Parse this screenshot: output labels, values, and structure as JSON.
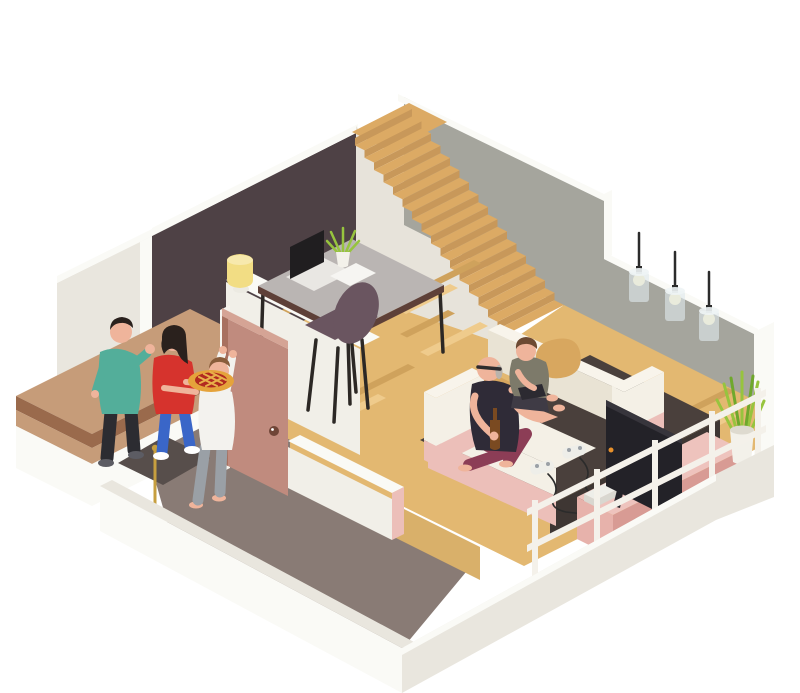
{
  "scene": {
    "description": "Isometric cutaway illustration of a two-level home: visitors with a pie arrive at the open front door greeted by a boy, while a grandfather and a child sit on a cream sofa in the living room near a TV, game controllers on a dark rug, a home-office desk with laptop by the staircase, three pendant lamps on the grey wall and a potted plant in the corner.",
    "rooms": [
      "home office",
      "staircase",
      "living room",
      "entry hall",
      "porch"
    ],
    "people": [
      {
        "id": "visitor-man",
        "label": "man waving hello"
      },
      {
        "id": "visitor-woman",
        "label": "woman carrying a lattice pie"
      },
      {
        "id": "boy-at-door",
        "label": "boy opening the front door"
      },
      {
        "id": "grandfather",
        "label": "grandfather with bottle on sofa"
      },
      {
        "id": "boy-gaming",
        "label": "child with gamepad on sofa"
      }
    ],
    "furniture": [
      "desk",
      "laptop",
      "desk plant",
      "table lamp",
      "office chair",
      "sofa",
      "tan pillow",
      "rug",
      "tv",
      "tv stand",
      "game console",
      "2 game controllers",
      "3 pendant lamps",
      "corner plant",
      "doormat",
      "front door",
      "railing",
      "gold pole"
    ],
    "counts": {
      "pendant_lamps": 3,
      "controllers": 2,
      "stairs_steps": 16
    }
  },
  "colors": {
    "bg": "#ffffff",
    "trim_bright": "#fafaf6",
    "wall_white": "#f1efe8",
    "wall_side": "#e9e6de",
    "wall_shade": "#e0ddd4",
    "office_wall": "#4e4145",
    "gray_wall": "#a5a59d",
    "stair_light_wall": "#e7e3da",
    "stair_tread": "#dcaa64",
    "stair_riser": "#c8985a",
    "wood_floor": "#e3b871",
    "wood_light": "#efcb8c",
    "wood_dark": "#cfa25c",
    "wood_cut": "#d9b06a",
    "porch": "#c69c79",
    "porch_edge": "#9a6a4c",
    "hall_floor": "#897b75",
    "doormat": "#574e4b",
    "door": "#c08b7e",
    "door_edge": "#a8705f",
    "door_top": "#d5a495",
    "knob": "#6f4537",
    "jamb": "#f6f4ee",
    "sofa_cream": "#f4f0e6",
    "sofa_cream_dark": "#e9e3d4",
    "sofa_top": "#f8f4eb",
    "sofa_pink": "#ecbfb9",
    "pillow": "#d8a75f",
    "rug": "#4a403c",
    "rug_dark": "#3e3633",
    "tv": "#232228",
    "tv_top": "#37353c",
    "tv_dot": "#e8912b",
    "stand_top": "#eec3bd",
    "stand_front": "#e7b2ab",
    "stand_side": "#d89b94",
    "console": "#eeeee9",
    "console_side": "#d9d7d0",
    "rail": "#f4f1ea",
    "plant": "#97c43e",
    "plant_dark": "#6fa82c",
    "pot": "#f3f1ea",
    "pot_shade": "#dedacf",
    "lamp": "#f2dd84",
    "lamp_top": "#f7e9ad",
    "lamp_base": "#eceae2",
    "desk_top": "#bab5b3",
    "desk_edge": "#5e4038",
    "desk_leg": "#2c2825",
    "chair": "#6a5560",
    "laptop_screen": "#201e20",
    "laptop_base": "#e9e7e3",
    "paper": "#f6f5f2",
    "skin": "#efb49b",
    "hair_dark": "#2a211d",
    "hair_gray": "#b9b3ac",
    "hair_brown": "#6d4a33",
    "hair_boy": "#8a5d3b",
    "man_teal": "#53ae9a",
    "man_pants": "#2c2c31",
    "shoe_gray": "#5c5c63",
    "woman_red": "#d6332d",
    "jeans": "#3a66c8",
    "shoe_white": "#ffffff",
    "pie_crust": "#e5a33b",
    "pie_fill": "#b22a20",
    "pie_lattice": "#e8b04a",
    "boy_shirt": "#f3f2ee",
    "boy_pants": "#9aa0a6",
    "tank": "#2f2b37",
    "grandpa_pants": "#8c3d56",
    "kid_shirt": "#7d7a6a",
    "kid_shorts": "#3f3b45",
    "tablet": "#2c2a31",
    "bottle": "#7a4a21",
    "glass": "#dfe9ec",
    "glass_top": "#eef4f5",
    "glow": "#f9efc3",
    "cord": "#2b2b2b",
    "gold": "#c79f3f",
    "glasses": "#2f2b2e"
  }
}
